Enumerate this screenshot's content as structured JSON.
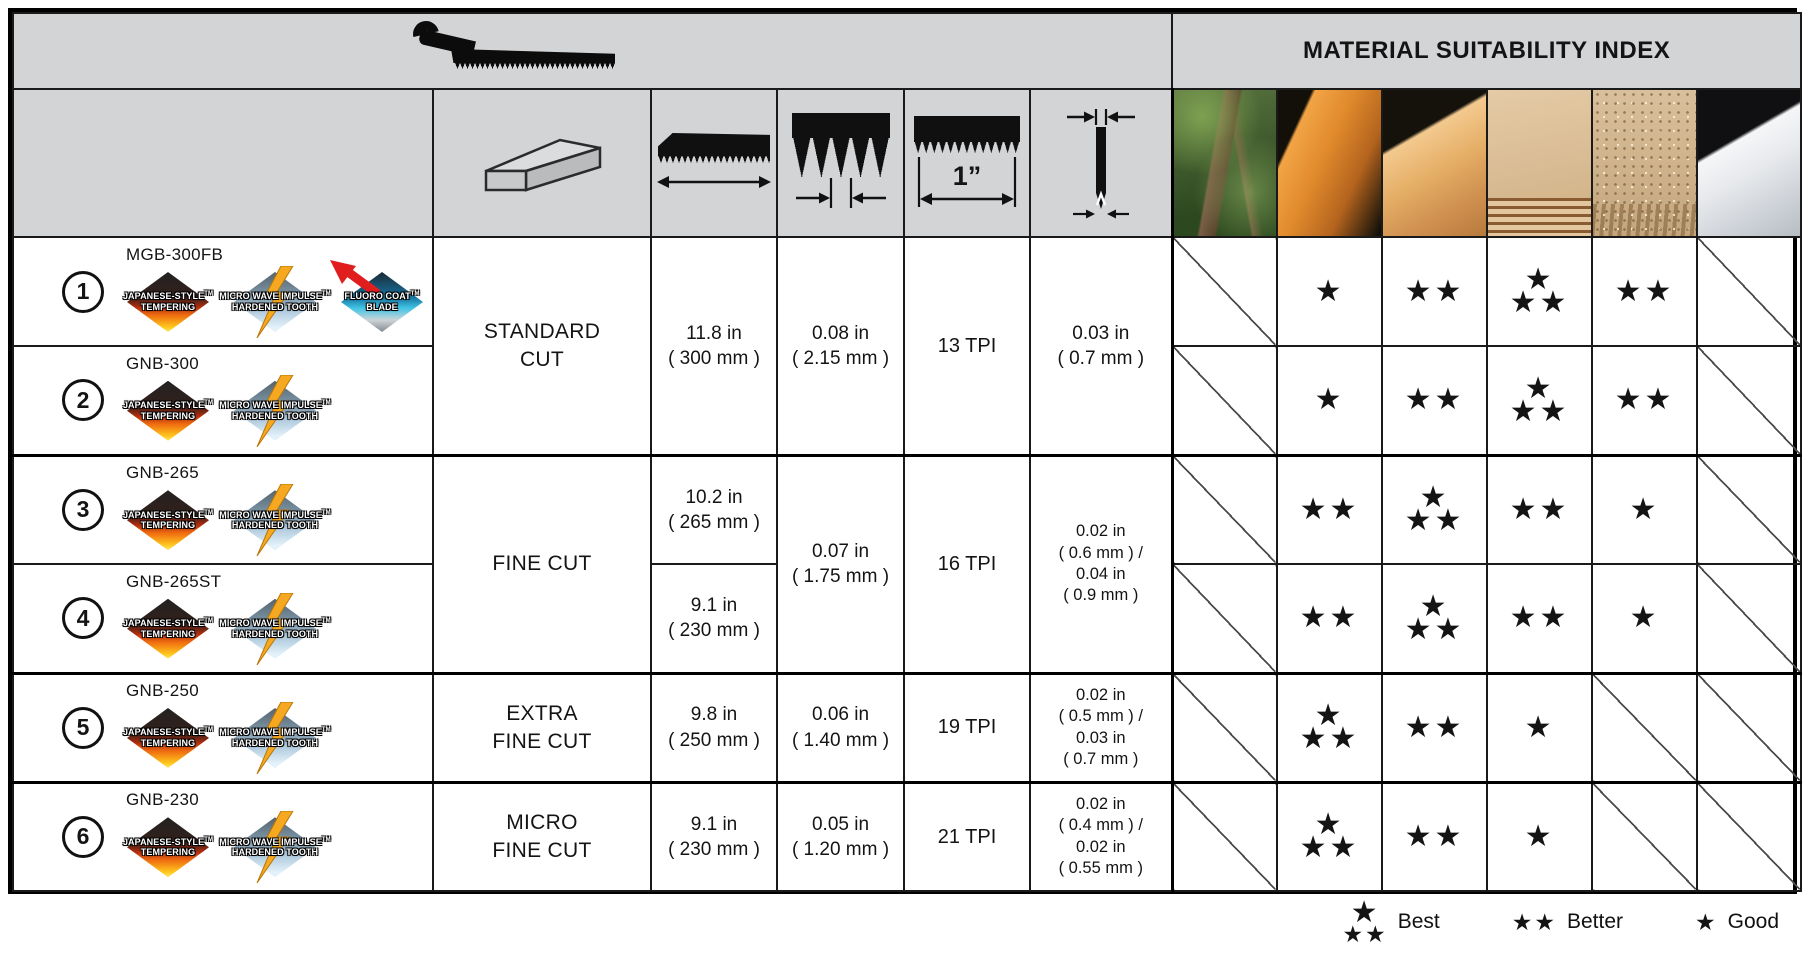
{
  "title": "MATERIAL SUITABILITY INDEX",
  "spec_header": {
    "tpi_unit_label": "1”",
    "icons": [
      "blade-cross-section-icon",
      "blade-length-icon",
      "tooth-pitch-icon",
      "teeth-per-inch-icon",
      "kerf-width-icon"
    ]
  },
  "materials": [
    {
      "name": "tree"
    },
    {
      "name": "softwood"
    },
    {
      "name": "hardwood"
    },
    {
      "name": "plywood"
    },
    {
      "name": "particle"
    },
    {
      "name": "sheet"
    }
  ],
  "badges": {
    "jst": {
      "lines": [
        "JAPANESE-STYLE",
        "TEMPERING"
      ],
      "tm": "TM"
    },
    "mwi": {
      "lines": [
        "MICRO WAVE IMPULSE",
        "HARDENED TOOTH"
      ],
      "tm": "TM"
    },
    "fcb": {
      "lines": [
        "FLUORO COAT",
        "BLADE"
      ],
      "tm": "TM"
    }
  },
  "rating_scale": {
    "3": "Best",
    "2": "Better",
    "1": "Good",
    "0": "not-suitable"
  },
  "legend": [
    {
      "stars": 3,
      "label": "Best"
    },
    {
      "stars": 2,
      "label": "Better"
    },
    {
      "stars": 1,
      "label": "Good"
    }
  ],
  "groups": [
    {
      "cut_lines": [
        "STANDARD",
        "CUT"
      ],
      "shared_length_lines": [
        "11.8 in",
        "( 300 mm )"
      ],
      "thickness_lines": [
        "0.08 in",
        "( 2.15 mm )"
      ],
      "tpi": "13 TPI",
      "kerf_lines": [
        "0.03 in",
        "( 0.7 mm )"
      ],
      "rows": [
        {
          "num": "1",
          "model": "MGB-300FB",
          "badges": [
            "jst",
            "mwi",
            "fcb"
          ],
          "ratings": [
            0,
            1,
            2,
            3,
            2,
            0
          ]
        },
        {
          "num": "2",
          "model": "GNB-300",
          "badges": [
            "jst",
            "mwi"
          ],
          "ratings": [
            0,
            1,
            2,
            3,
            2,
            0
          ]
        }
      ]
    },
    {
      "cut_lines": [
        "FINE CUT"
      ],
      "thickness_lines": [
        "0.07 in",
        "( 1.75 mm )"
      ],
      "tpi": "16 TPI",
      "kerf_lines": [
        "0.02 in",
        "( 0.6 mm ) /",
        "0.04 in",
        "( 0.9 mm )"
      ],
      "rows": [
        {
          "num": "3",
          "model": "GNB-265",
          "badges": [
            "jst",
            "mwi"
          ],
          "length_lines": [
            "10.2 in",
            "( 265 mm )"
          ],
          "ratings": [
            0,
            2,
            3,
            2,
            1,
            0
          ]
        },
        {
          "num": "4",
          "model": "GNB-265ST",
          "badges": [
            "jst",
            "mwi"
          ],
          "length_lines": [
            "9.1 in",
            "( 230 mm )"
          ],
          "ratings": [
            0,
            2,
            3,
            2,
            1,
            0
          ]
        }
      ]
    },
    {
      "cut_lines": [
        "EXTRA",
        "FINE CUT"
      ],
      "shared_length_lines": [
        "9.8 in",
        "( 250 mm )"
      ],
      "thickness_lines": [
        "0.06 in",
        "( 1.40 mm )"
      ],
      "tpi": "19 TPI",
      "kerf_lines": [
        "0.02 in",
        "( 0.5 mm ) /",
        "0.03 in",
        "( 0.7 mm )"
      ],
      "rows": [
        {
          "num": "5",
          "model": "GNB-250",
          "badges": [
            "jst",
            "mwi"
          ],
          "ratings": [
            0,
            3,
            2,
            1,
            0,
            0
          ]
        }
      ]
    },
    {
      "cut_lines": [
        "MICRO",
        "FINE CUT"
      ],
      "shared_length_lines": [
        "9.1 in",
        "( 230 mm )"
      ],
      "thickness_lines": [
        "0.05 in",
        "( 1.20 mm )"
      ],
      "tpi": "21 TPI",
      "kerf_lines": [
        "0.02 in",
        "( 0.4 mm ) /",
        "0.02 in",
        "( 0.55 mm )"
      ],
      "rows": [
        {
          "num": "6",
          "model": "GNB-230",
          "badges": [
            "jst",
            "mwi"
          ],
          "ratings": [
            0,
            3,
            2,
            1,
            0,
            0
          ]
        }
      ]
    }
  ]
}
